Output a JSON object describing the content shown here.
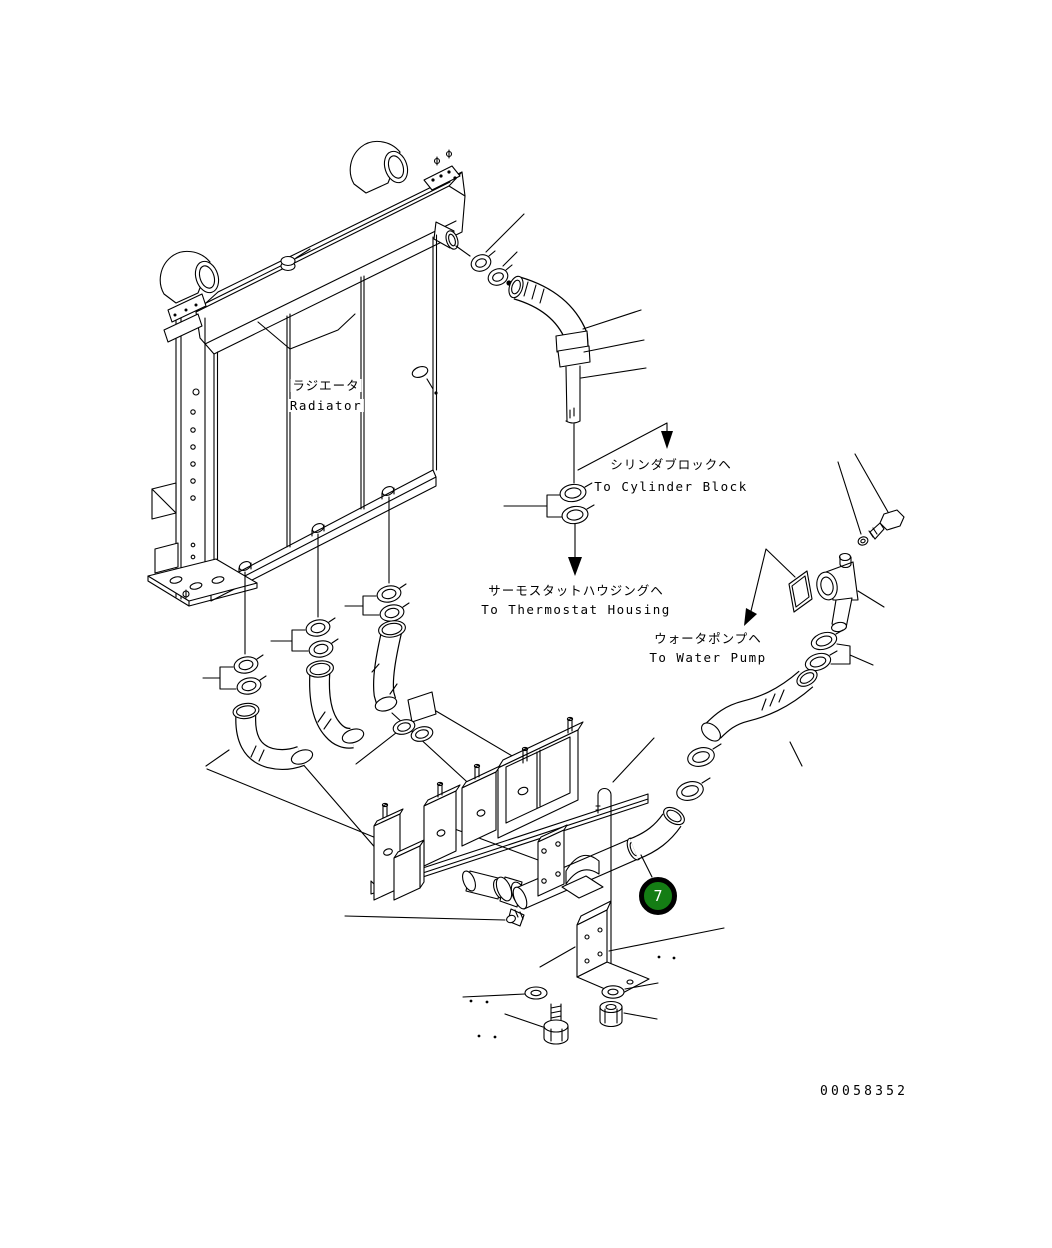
{
  "page": {
    "background": "#ffffff",
    "width": 1052,
    "height": 1248
  },
  "diagram": {
    "type": "parts-exploded-view",
    "line_color": "#000000",
    "labels": {
      "radiator": {
        "jp": "ラジエータ",
        "en": "Radiator"
      },
      "cylinder_block": {
        "jp": "シリンダブロックヘ",
        "en": "To Cylinder Block"
      },
      "thermostat_housing": {
        "jp": "サーモスタットハウジングヘ",
        "en": "To Thermostat Housing"
      },
      "water_pump": {
        "jp": "ウォータポンプヘ",
        "en": "To Water Pump"
      }
    },
    "callout": {
      "number": "7",
      "fill_color": "#147d14",
      "ring_color": "#000000",
      "number_color": "#ffffff"
    },
    "drawing_number": "00058352"
  }
}
